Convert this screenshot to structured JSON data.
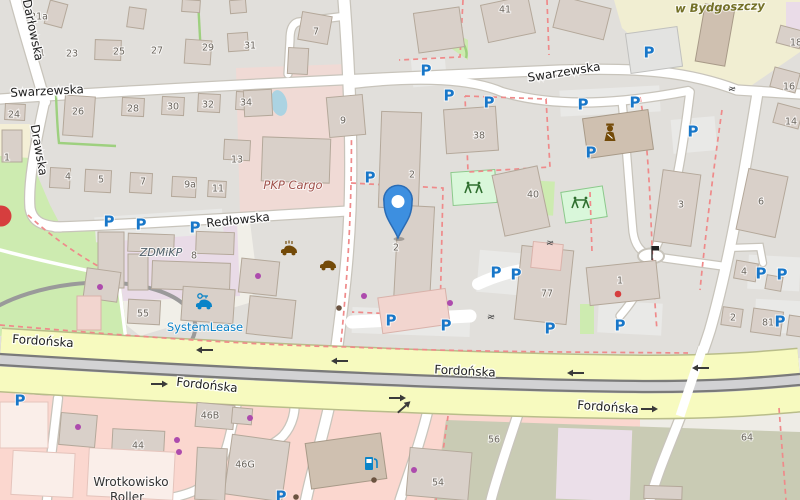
{
  "colors": {
    "land": "#eeece6",
    "residential": "#e1dfdb",
    "whitezone": "#f1efe8",
    "school": "#f1eed2",
    "industrial_pink": "#f0dad5",
    "industrial_purple": "#e9dbe7",
    "park": "#cdebb0",
    "playground_fill": "#d9f7da",
    "playground_stroke": "#8bc98b",
    "pond": "#abd3e2",
    "retail": "#fbd7cf",
    "brownfield": "#c9cbb4",
    "lavender": "#ebdfe9",
    "road_fill": "#ffffff",
    "road_casing": "#c8c4bb",
    "band_fill": "#f7fabf",
    "band_casing": "#b9bd8a",
    "rail": "#7a7a7a",
    "rail_bed": "#d2d2d4",
    "boundary": "#ef8a8a",
    "hedge": "#9ed07f",
    "building": "#d9d0c9",
    "building_stroke": "#b4a89a",
    "parking_blue": "#1877c9",
    "poi_brown": "#734a08",
    "poi_blue": "#0a84c8",
    "shop_purple": "#ad4bad",
    "dot_red": "#d63e3e",
    "marker_fill": "#3d8fe0",
    "marker_stroke": "#2a6cb5",
    "street_text": "#1f1f1f",
    "housenum_text": "#6c675f",
    "arrow": "#3a3a3a",
    "gray_circle": "#9a9a9a"
  },
  "areas": [
    {
      "sh": "rect",
      "x": 0,
      "y": 0,
      "w": 800,
      "h": 500,
      "f": "#eeece6"
    },
    {
      "sh": "rect",
      "x": 0,
      "y": 0,
      "w": 800,
      "h": 358,
      "f": "#e1dfdb"
    },
    {
      "sh": "poly",
      "pts": "95,230 250,222 255,262 252,302 140,336 98,302",
      "f": "#f1efe8"
    },
    {
      "sh": "poly",
      "pts": "614,0 800,0 800,52 742,92 712,88 660,62 622,28",
      "f": "#f1eed2"
    },
    {
      "sh": "rect",
      "x": 786,
      "y": 2,
      "w": 14,
      "h": 42,
      "f": "#eadce8"
    },
    {
      "sh": "poly",
      "pts": "236,68 348,64 350,212 240,217",
      "f": "#f0dad5"
    },
    {
      "sh": "poly",
      "pts": "93,229 237,221 240,296 100,302",
      "f": "#e9dbe7"
    },
    {
      "sh": "rect",
      "x": 0,
      "y": 124,
      "w": 30,
      "h": 54,
      "f": "#f4efd6"
    },
    {
      "sh": "poly",
      "pts": "0,156 30,158 50,205 62,228 95,231 120,278 128,340 0,336",
      "f": "#cdebb0"
    },
    {
      "sh": "rect",
      "x": 530,
      "y": 181,
      "w": 24,
      "h": 34,
      "r": 3,
      "f": "#cdebb0"
    },
    {
      "sh": "rect",
      "x": 580,
      "y": 304,
      "w": 14,
      "h": 30,
      "f": "#cdebb0"
    },
    {
      "sh": "poly",
      "pts": "438,24 468,40 468,60 442,42",
      "f": "#cdebb0"
    },
    {
      "sh": "ellipse",
      "x": 279,
      "y": 103,
      "rx": 8,
      "ry": 13,
      "r": -12,
      "f": "#abd3e2"
    },
    {
      "sh": "rect",
      "x": 412,
      "y": 58,
      "w": 34,
      "h": 28,
      "r": -5,
      "f": "#e9e9e7"
    },
    {
      "sh": "rect",
      "x": 560,
      "y": 88,
      "w": 100,
      "h": 26,
      "r": -3,
      "f": "#e9e9e7"
    },
    {
      "sh": "rect",
      "x": 672,
      "y": 118,
      "w": 44,
      "h": 34,
      "r": -5,
      "f": "#e9e9e7"
    },
    {
      "sh": "rect",
      "x": 95,
      "y": 213,
      "w": 128,
      "h": 25,
      "r": -4,
      "f": "#e9e9e7"
    },
    {
      "sh": "rect",
      "x": 352,
      "y": 309,
      "w": 118,
      "h": 26,
      "r": 2,
      "f": "#e9e9e7"
    },
    {
      "sh": "rect",
      "x": 478,
      "y": 252,
      "w": 54,
      "h": 42,
      "r": 5,
      "f": "#e9e9e7"
    },
    {
      "sh": "rect",
      "x": 598,
      "y": 302,
      "w": 64,
      "h": 32,
      "r": 3,
      "f": "#e9e9e7"
    },
    {
      "sh": "rect",
      "x": 748,
      "y": 256,
      "w": 52,
      "h": 34,
      "r": 3,
      "f": "#e9e9e7"
    },
    {
      "sh": "rect",
      "x": 755,
      "y": 300,
      "w": 48,
      "h": 33,
      "r": 3,
      "f": "#e9e9e7"
    },
    {
      "sh": "rect",
      "x": 5,
      "y": 388,
      "w": 32,
      "h": 26,
      "r": 3,
      "f": "#e9e9e7"
    },
    {
      "sh": "poly",
      "pts": "0,386 640,416 640,500 0,500",
      "f": "#fbd7cf"
    },
    {
      "sh": "poly",
      "pts": "446,420 800,432 800,500 434,500",
      "f": "#c9cbb4"
    },
    {
      "sh": "rect",
      "x": 557,
      "y": 429,
      "w": 74,
      "h": 71,
      "r": 2,
      "f": "#ebdfe9"
    },
    {
      "sh": "rect",
      "x": 452,
      "y": 171,
      "w": 44,
      "h": 33,
      "r": -4,
      "f": "#d9f7da",
      "s": "#8bc98b"
    },
    {
      "sh": "rect",
      "x": 563,
      "y": 189,
      "w": 42,
      "h": 31,
      "r": -9,
      "f": "#d9f7da",
      "s": "#8bc98b"
    }
  ],
  "gray_circle": {
    "cx": 78,
    "cy": 338,
    "rx": 118,
    "ry": 54,
    "rot": -7
  },
  "roads": [
    {
      "d": "M 14,-6 C 22,25 33,60 45,102",
      "w": 10
    },
    {
      "d": "M 0,99 C 180,87 420,76 560,70 C 640,67 690,72 737,90 L 800,94",
      "w": 9
    },
    {
      "d": "M 45,100 C 34,150 28,185 30,208 C 32,220 40,226 60,227",
      "w": 9
    },
    {
      "d": "M 55,227 C 150,224 260,216 348,211",
      "w": 9
    },
    {
      "d": "M 344,0 C 350,80 352,150 350,210 C 348,260 343,300 337,346",
      "w": 11
    },
    {
      "d": "M 346,16 L 298,22 C 292,24 290,30 290,40 L 288,74",
      "w": 7
    },
    {
      "d": "M 352,84 C 420,76 472,79 502,92 C 560,109 625,103 688,91",
      "w": 8
    },
    {
      "d": "M 622,101 C 626,140 630,200 633,232 C 635,246 641,252 650,256",
      "w": 7
    },
    {
      "d": "M 690,92 C 684,140 678,180 668,215 C 662,235 657,246 651,256",
      "w": 7.5
    },
    {
      "d": "M 664,258 L 722,266",
      "w": 7
    },
    {
      "d": "M 649,263 C 642,288 632,302 620,316",
      "w": 7
    },
    {
      "d": "M 757,96 C 744,175 730,260 710,330 C 703,352 697,368 690,380",
      "w": 10
    },
    {
      "d": "M 728,248 L 760,247 L 763,263",
      "w": 6
    },
    {
      "d": "M 331,398 C 322,440 312,470 306,500",
      "w": 10
    },
    {
      "d": "M 430,402 C 420,445 408,475 400,500",
      "w": 9
    },
    {
      "d": "M 520,408 C 507,448 497,476 491,500",
      "w": 9
    },
    {
      "d": "M 58,398 C 53,442 49,470 47,500",
      "w": 8
    },
    {
      "d": "M 238,398 C 231,432 226,458 214,476 C 204,489 188,495 165,499",
      "w": 8
    },
    {
      "d": "M 229,441 C 246,453 267,451 283,436 C 293,425 296,410 294,399",
      "w": 8
    },
    {
      "d": "M 683,410 C 672,440 658,470 650,500",
      "w": 9
    },
    {
      "d": "M 0,250 C 45,262 85,270 118,277 L 126,340",
      "w": 3.5,
      "nc": 1
    },
    {
      "d": "M 352,322 L 470,316",
      "w": 13,
      "nc": 1
    },
    {
      "d": "M 478,284 C 495,276 512,271 532,268",
      "w": 12,
      "nc": 1
    }
  ],
  "roundabout": {
    "cx": 651,
    "cy": 256,
    "rx": 13,
    "ry": 7.5
  },
  "band": {
    "path": "M 0,360 C 260,376 500,386 650,387 C 730,387 775,382 800,380",
    "w": 62
  },
  "rails": {
    "bed": "M 0,360 C 260,376 500,386 650,387 C 730,387 775,382 800,380",
    "a": "M 0,354 C 260,370 500,380 650,381 C 730,381 775,376 800,374",
    "b": "M 0,365 C 260,381 500,391 650,392 C 730,392 775,387 800,385"
  },
  "crossing": {
    "d": "M 703,347 L 680,416",
    "w": 9
  },
  "boundaries": [
    "M 351,95 C 353,200 348,270 341,342",
    "M 351,183 L 443,188 L 440,316 L 352,312",
    "M 463,0 L 460,57 L 399,60",
    "M 465,96 L 546,99 L 550,167 L 468,172 L 465,96",
    "M 640,97 C 652,160 650,250 657,330",
    "M 0,325 C 120,335 240,345 350,347 C 460,352 580,352 688,353",
    "M 722,110 C 712,180 705,240 700,290",
    "M 448,416 L 436,500",
    "M 779,408 L 786,500",
    "M 547,0 L 549,55",
    "M 590,192 L 592,252",
    "M 28,215 C 55,240 85,260 118,277"
  ],
  "hedges": [
    "M 198,0 L 201,56",
    "M 56,95 C 57,120 58,135 59,143 L 116,146",
    "M 441,28 C 452,30 461,38 465,47 C 467,52 467,55 466,58"
  ],
  "buildings": [
    [
      47,
      2,
      18,
      24,
      15
    ],
    [
      128,
      8,
      17,
      20,
      8
    ],
    [
      182,
      0,
      18,
      12,
      4
    ],
    [
      230,
      0,
      16,
      13,
      -5
    ],
    [
      95,
      40,
      26,
      20,
      2
    ],
    [
      185,
      40,
      26,
      24,
      4
    ],
    [
      228,
      33,
      20,
      18,
      -4
    ],
    [
      5,
      104,
      20,
      16,
      3
    ],
    [
      64,
      96,
      30,
      40,
      4
    ],
    [
      122,
      98,
      22,
      18,
      3
    ],
    [
      162,
      97,
      22,
      18,
      3
    ],
    [
      198,
      94,
      22,
      18,
      3
    ],
    [
      236,
      92,
      22,
      18,
      3
    ],
    [
      224,
      140,
      26,
      20,
      3
    ],
    [
      2,
      130,
      20,
      32,
      0
    ],
    [
      288,
      48,
      20,
      26,
      3
    ],
    [
      300,
      14,
      30,
      28,
      10
    ],
    [
      416,
      10,
      46,
      40,
      -8
    ],
    [
      484,
      0,
      48,
      38,
      -12
    ],
    [
      556,
      2,
      52,
      32,
      14
    ],
    [
      328,
      96,
      36,
      40,
      -5
    ],
    [
      244,
      90,
      28,
      26,
      -3
    ],
    [
      262,
      138,
      68,
      44,
      2
    ],
    [
      50,
      168,
      20,
      20,
      3
    ],
    [
      85,
      170,
      26,
      22,
      3
    ],
    [
      130,
      173,
      22,
      20,
      3
    ],
    [
      172,
      177,
      24,
      20,
      3
    ],
    [
      208,
      181,
      18,
      16,
      3
    ],
    [
      98,
      232,
      26,
      56,
      0
    ],
    [
      128,
      234,
      46,
      18,
      2
    ],
    [
      128,
      254,
      20,
      36,
      0
    ],
    [
      152,
      262,
      78,
      28,
      2
    ],
    [
      196,
      232,
      38,
      22,
      2
    ],
    [
      85,
      270,
      34,
      30,
      8
    ],
    [
      128,
      300,
      32,
      24,
      3
    ],
    [
      240,
      260,
      38,
      34,
      6
    ],
    [
      182,
      288,
      52,
      34,
      4
    ],
    [
      248,
      298,
      46,
      38,
      6
    ],
    [
      77,
      296,
      24,
      34,
      0,
      "p"
    ],
    [
      380,
      112,
      40,
      96,
      2
    ],
    [
      396,
      206,
      36,
      98,
      3
    ],
    [
      445,
      108,
      52,
      44,
      -4
    ],
    [
      498,
      170,
      46,
      62,
      -12
    ],
    [
      658,
      172,
      38,
      72,
      8
    ],
    [
      518,
      248,
      52,
      74,
      6
    ],
    [
      532,
      243,
      30,
      26,
      6,
      "p"
    ],
    [
      588,
      264,
      70,
      38,
      -6
    ],
    [
      380,
      293,
      68,
      36,
      -8,
      "p"
    ],
    [
      585,
      114,
      66,
      40,
      -8,
      "d"
    ],
    [
      628,
      30,
      52,
      40,
      -8,
      "g"
    ],
    [
      700,
      6,
      30,
      58,
      10,
      "d"
    ],
    [
      742,
      172,
      40,
      62,
      12
    ],
    [
      735,
      262,
      22,
      18,
      10
    ],
    [
      766,
      276,
      16,
      14,
      10
    ],
    [
      722,
      308,
      20,
      18,
      8
    ],
    [
      752,
      310,
      30,
      24,
      8
    ],
    [
      788,
      316,
      14,
      20,
      8
    ],
    [
      778,
      28,
      24,
      18,
      15
    ],
    [
      772,
      70,
      26,
      20,
      15
    ],
    [
      775,
      106,
      26,
      20,
      15
    ],
    [
      308,
      438,
      76,
      46,
      -8,
      "d"
    ],
    [
      408,
      450,
      62,
      48,
      5
    ],
    [
      228,
      438,
      58,
      60,
      8
    ],
    [
      196,
      448,
      30,
      52,
      3
    ],
    [
      196,
      404,
      38,
      24,
      5
    ],
    [
      232,
      408,
      20,
      16,
      5
    ],
    [
      112,
      430,
      52,
      32,
      3
    ],
    [
      88,
      450,
      86,
      48,
      3,
      "w"
    ],
    [
      60,
      414,
      36,
      32,
      5
    ],
    [
      0,
      402,
      48,
      46,
      0,
      "w"
    ],
    [
      12,
      452,
      62,
      44,
      3,
      "w"
    ],
    [
      644,
      486,
      38,
      13,
      2
    ]
  ],
  "street_labels": [
    {
      "t": "Darłowska",
      "x": 33,
      "y": 30,
      "r": 78
    },
    {
      "t": "Swarzewska",
      "x": 47,
      "y": 91,
      "r": -3
    },
    {
      "t": "Swarzewska",
      "x": 564,
      "y": 72,
      "r": -9
    },
    {
      "t": "Drawska",
      "x": 39,
      "y": 150,
      "r": 80
    },
    {
      "t": "Redłowska",
      "x": 238,
      "y": 220,
      "r": -6
    },
    {
      "t": "Fordońska",
      "x": 43,
      "y": 341,
      "r": 4
    },
    {
      "t": "Fordońska",
      "x": 207,
      "y": 385,
      "r": 6
    },
    {
      "t": "Fordońska",
      "x": 465,
      "y": 371,
      "r": 3
    },
    {
      "t": "Fordońska",
      "x": 608,
      "y": 407,
      "r": 4
    }
  ],
  "area_labels": [
    {
      "t": "w Bydgoszczy",
      "x": 720,
      "y": 7,
      "cls": "school",
      "r": -2
    },
    {
      "t": "PKP Cargo",
      "x": 293,
      "y": 185,
      "cls": "industrial",
      "r": 0
    },
    {
      "t": "ZDMiKP",
      "x": 161,
      "y": 252,
      "cls": "zdm",
      "r": 0
    },
    {
      "t": "SystemLease",
      "x": 205,
      "y": 327,
      "cls": "lease",
      "r": 0
    },
    {
      "t": "Wrotkowisko",
      "x": 131,
      "y": 482,
      "cls": "poi",
      "r": 0
    },
    {
      "t": "Roller",
      "x": 127,
      "y": 497,
      "cls": "poi",
      "r": 0
    }
  ],
  "house_numbers": [
    [
      "21a",
      39,
      16
    ],
    [
      "21",
      39,
      52
    ],
    [
      "23",
      72,
      53
    ],
    [
      "25",
      119,
      51
    ],
    [
      "27",
      157,
      50
    ],
    [
      "29",
      208,
      47
    ],
    [
      "31",
      250,
      45
    ],
    [
      "24",
      14,
      114
    ],
    [
      "26",
      78,
      111
    ],
    [
      "28",
      133,
      108
    ],
    [
      "30",
      173,
      106
    ],
    [
      "32",
      208,
      104
    ],
    [
      "34",
      246,
      102
    ],
    [
      "1",
      7,
      157
    ],
    [
      "13",
      237,
      159
    ],
    [
      "7",
      316,
      31
    ],
    [
      "9",
      343,
      120
    ],
    [
      "41",
      505,
      9
    ],
    [
      "38",
      479,
      135
    ],
    [
      "2",
      412,
      174
    ],
    [
      "2",
      396,
      247
    ],
    [
      "40",
      533,
      194
    ],
    [
      "3",
      681,
      204
    ],
    [
      "6",
      761,
      201
    ],
    [
      "4",
      68,
      176
    ],
    [
      "5",
      101,
      179
    ],
    [
      "7",
      143,
      181
    ],
    [
      "9a",
      190,
      184
    ],
    [
      "11",
      218,
      188
    ],
    [
      "8",
      194,
      255
    ],
    [
      "55",
      143,
      313
    ],
    [
      "77",
      547,
      293
    ],
    [
      "1",
      620,
      280
    ],
    [
      "4",
      744,
      271
    ],
    [
      "2",
      733,
      317
    ],
    [
      "81",
      768,
      322
    ],
    [
      "16",
      789,
      86
    ],
    [
      "14",
      791,
      121
    ],
    [
      "18",
      796,
      42
    ],
    [
      "44",
      138,
      445
    ],
    [
      "46B",
      210,
      415
    ],
    [
      "46G",
      245,
      464
    ],
    [
      "54",
      438,
      482
    ],
    [
      "56",
      494,
      439
    ],
    [
      "64",
      747,
      437
    ]
  ],
  "parking": [
    [
      426,
      70
    ],
    [
      449,
      95
    ],
    [
      489,
      102
    ],
    [
      649,
      52
    ],
    [
      583,
      104
    ],
    [
      635,
      102
    ],
    [
      693,
      131
    ],
    [
      591,
      152
    ],
    [
      109,
      221
    ],
    [
      141,
      224
    ],
    [
      195,
      227
    ],
    [
      370,
      177
    ],
    [
      391,
      320
    ],
    [
      446,
      325
    ],
    [
      496,
      272
    ],
    [
      516,
      274
    ],
    [
      550,
      328
    ],
    [
      620,
      325
    ],
    [
      761,
      273
    ],
    [
      782,
      274
    ],
    [
      780,
      321
    ],
    [
      20,
      400
    ],
    [
      281,
      496
    ]
  ],
  "dots": {
    "purple": [
      [
        100,
        287
      ],
      [
        258,
        276
      ],
      [
        364,
        296
      ],
      [
        450,
        303
      ],
      [
        78,
        427
      ],
      [
        177,
        440
      ],
      [
        179,
        452
      ],
      [
        250,
        418
      ],
      [
        414,
        470
      ]
    ],
    "red": [
      [
        618,
        294
      ]
    ],
    "brown": [
      [
        339,
        308
      ],
      [
        374,
        480
      ],
      [
        296,
        497
      ]
    ]
  },
  "red_big_dot": {
    "x": 1,
    "y": 216,
    "r": 10.5
  },
  "arrows": [
    {
      "x": 206,
      "y": 350,
      "dir": "left"
    },
    {
      "x": 341,
      "y": 361,
      "dir": "left"
    },
    {
      "x": 577,
      "y": 373,
      "dir": "left"
    },
    {
      "x": 702,
      "y": 368,
      "dir": "left"
    },
    {
      "x": 158,
      "y": 384,
      "dir": "right"
    },
    {
      "x": 396,
      "y": 398,
      "dir": "right"
    },
    {
      "x": 648,
      "y": 409,
      "dir": "right"
    },
    {
      "x": 403,
      "y": 408,
      "dir": "ne"
    }
  ],
  "gates": [
    [
      732,
      89
    ],
    [
      550,
      243
    ],
    [
      491,
      317
    ]
  ],
  "pois": [
    {
      "type": "police",
      "x": 610,
      "y": 133
    },
    {
      "type": "playground",
      "x": 474,
      "y": 188
    },
    {
      "type": "playground",
      "x": 581,
      "y": 203
    },
    {
      "type": "car-wash",
      "x": 289,
      "y": 251
    },
    {
      "type": "car",
      "x": 328,
      "y": 266
    },
    {
      "type": "car-rental",
      "x": 204,
      "y": 305
    },
    {
      "type": "fuel",
      "x": 371,
      "y": 464
    },
    {
      "type": "flag",
      "x": 652,
      "y": 252
    }
  ],
  "marker": {
    "x": 398,
    "y": 238
  }
}
